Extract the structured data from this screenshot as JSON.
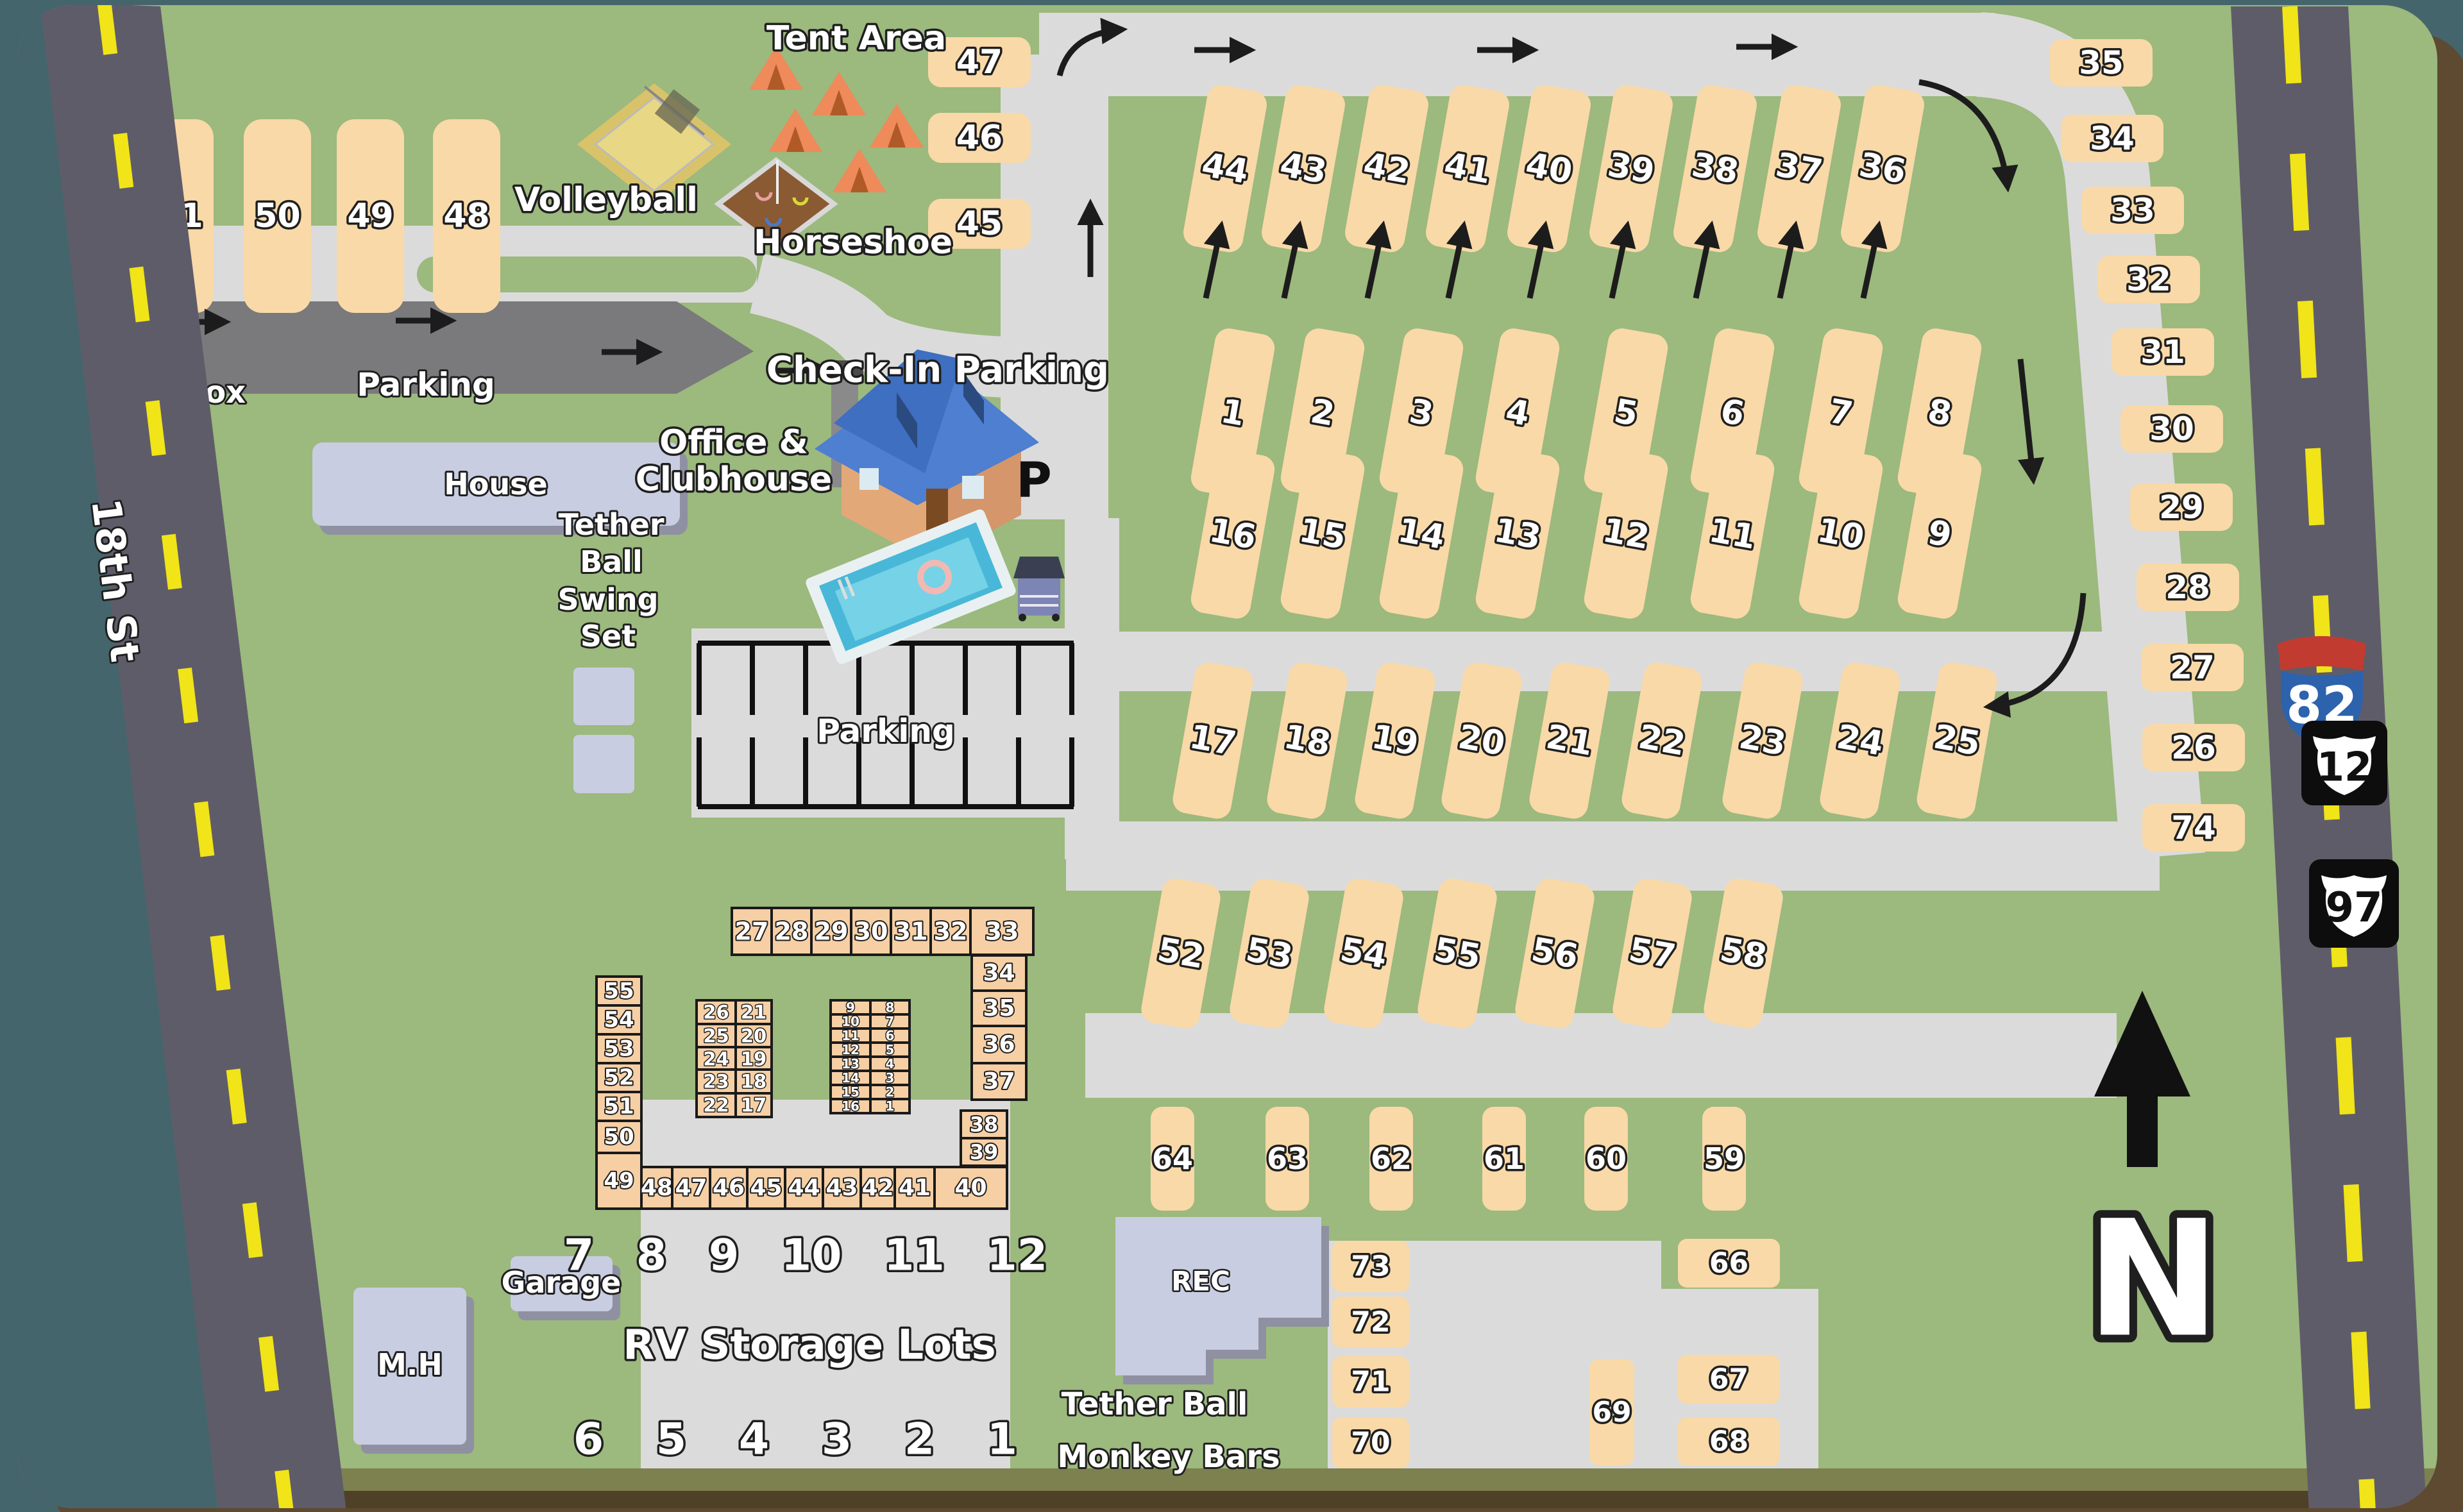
{
  "labels": {
    "tent_area": "Tent Area",
    "volleyball": "Volleyball",
    "horseshoe": "Horseshoe",
    "mail_box": "Mail Box",
    "parking_upper": "Parking",
    "parking_lot": "Parking",
    "house": "House",
    "office_line1": "Office &",
    "office_line2": "Clubhouse",
    "tether_line1": "Tether",
    "tether_line2": "Ball",
    "swing_line1": "Swing",
    "swing_line2": "Set",
    "check_in": "Check-In Parking",
    "p": "P",
    "rec": "REC",
    "mh": "M.H",
    "garage": "Garage",
    "tether_monkey_line1": "Tether Ball",
    "tether_monkey_line2": "Monkey Bars",
    "street": "18th St",
    "north": "N"
  },
  "shields": {
    "interstate": "82",
    "us_route_upper": "12",
    "us_route_lower": "97"
  },
  "sites": {
    "row_48_51": [
      "51",
      "50",
      "49",
      "48"
    ],
    "stack_45_47": [
      "47",
      "46",
      "45"
    ],
    "row_36_44": [
      "44",
      "43",
      "42",
      "41",
      "40",
      "39",
      "38",
      "37",
      "36"
    ],
    "row_1_8": [
      "1",
      "2",
      "3",
      "4",
      "5",
      "6",
      "7",
      "8"
    ],
    "row_16_9": [
      "16",
      "15",
      "14",
      "13",
      "12",
      "11",
      "10",
      "9"
    ],
    "row_17_25": [
      "17",
      "18",
      "19",
      "20",
      "21",
      "22",
      "23",
      "24",
      "25"
    ],
    "row_52_58": [
      "52",
      "53",
      "54",
      "55",
      "56",
      "57",
      "58"
    ],
    "row_64_59": [
      "64",
      "63",
      "62",
      "61",
      "60",
      "59"
    ],
    "right_column": [
      "35",
      "34",
      "33",
      "32",
      "31",
      "30",
      "29",
      "28",
      "27",
      "26",
      "74"
    ],
    "courtyard_left": [
      "73",
      "72",
      "71",
      "70"
    ],
    "courtyard_right": [
      "66",
      "67",
      "68"
    ],
    "courtyard_vertical": [
      "69"
    ]
  },
  "rv_storage": {
    "title": "RV Storage Lots",
    "top_numbers": "7 8 9 10 11 12",
    "bottom_numbers": "6 5 4 3 2 1",
    "top_row": [
      "27",
      "28",
      "29",
      "30",
      "31",
      "32",
      "33"
    ],
    "right_col": [
      "34",
      "35",
      "36",
      "37"
    ],
    "below_right": [
      "38",
      "39"
    ],
    "left_col": [
      "55",
      "54",
      "53",
      "52",
      "51",
      "50",
      "49"
    ],
    "bottom_row": [
      "48",
      "47",
      "46",
      "45",
      "44",
      "43",
      "42",
      "41",
      "40"
    ],
    "pair_left": [
      [
        "26",
        "21"
      ],
      [
        "25",
        "20"
      ],
      [
        "24",
        "19"
      ],
      [
        "23",
        "18"
      ],
      [
        "22",
        "17"
      ]
    ],
    "pair_right": [
      [
        "9",
        "8"
      ],
      [
        "10",
        "7"
      ],
      [
        "11",
        "6"
      ],
      [
        "12",
        "5"
      ],
      [
        "13",
        "4"
      ],
      [
        "14",
        "3"
      ],
      [
        "15",
        "2"
      ],
      [
        "16",
        "1"
      ]
    ]
  },
  "colors": {
    "grass": "#9CB97E",
    "internal_road": "#DBDBDB",
    "street_asphalt": "#5F5C69",
    "centerline_yellow": "#F1E418",
    "site_fill": "#F9D9A7",
    "storage_fill": "#F6CFA4",
    "building_fill": "#C8CDE1",
    "parking_strip": "#7A797B",
    "interstate_red": "#C23B30",
    "interstate_blue": "#2D62AC"
  }
}
